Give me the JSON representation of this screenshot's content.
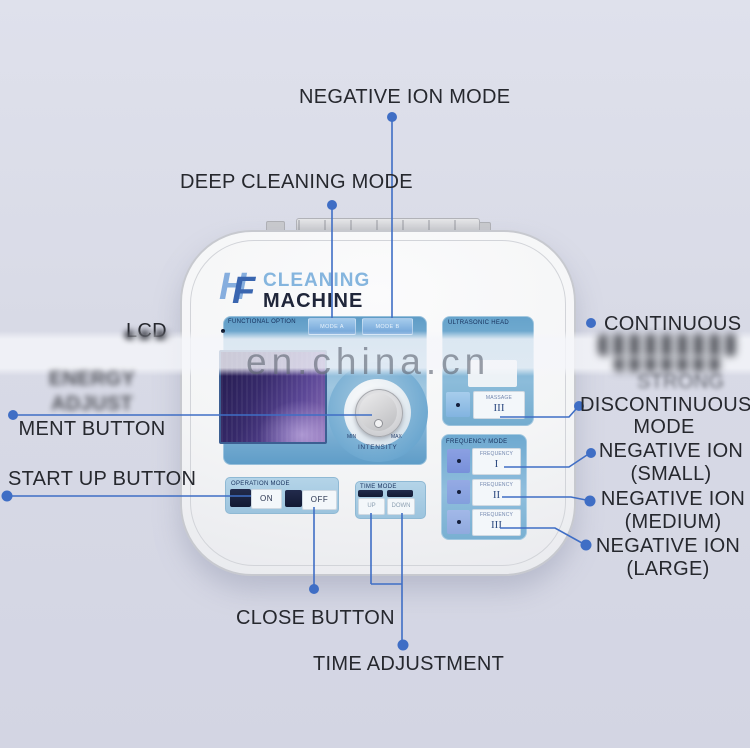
{
  "watermark": {
    "text": "en.china.cn"
  },
  "logo": {
    "initial_h": "H",
    "initial_f": "F",
    "name_line1": "CLEANING",
    "name_line2": "MACHINE"
  },
  "panel_functional": {
    "title": "FUNCTIONAL OPTION",
    "mode_a": "MODE A",
    "mode_b": "MODE B",
    "min": "MIN",
    "max": "MAX",
    "intensity": "INTENSITY"
  },
  "panel_ultrasonic": {
    "title": "ULTRASONIC HEAD",
    "massage_caption": "MASSAGE",
    "massage_numeral": "III"
  },
  "panel_frequency": {
    "title": "FREQUENCY MODE",
    "rows": [
      {
        "caption": "FREQUENCY",
        "numeral": "I"
      },
      {
        "caption": "FREQUENCY",
        "numeral": "II"
      },
      {
        "caption": "FREQUENCY",
        "numeral": "III"
      }
    ]
  },
  "panel_operation": {
    "title": "OPERATION MODE",
    "on_label": "ON",
    "off_label": "OFF"
  },
  "panel_time": {
    "title": "TIME MODE",
    "up_label": "UP",
    "down_label": "DOWN"
  },
  "callouts": {
    "negative_ion_mode": "NEGATIVE ION MODE",
    "deep_cleaning_mode": "DEEP CLEANING MODE",
    "lcd": "LCD",
    "energy_line1": "ENERGY ADJUST",
    "energy_line2": "MENT BUTTON",
    "start_up": "START UP BUTTON",
    "close": "CLOSE BUTTON",
    "time_adjustment": "TIME ADJUSTMENT",
    "continuous": "CONTINUOUS",
    "strong": "STRONG",
    "discontinuous_line1": "DISCONTINUOUS",
    "discontinuous_line2": "MODE",
    "neg_small_line1": "NEGATIVE ION",
    "neg_small_line2": "(SMALL)",
    "neg_medium_line1": "NEGATIVE ION",
    "neg_medium_line2": "(MEDIUM)",
    "neg_large_line1": "NEGATIVE ION",
    "neg_large_line2": "(LARGE)"
  },
  "colors": {
    "accent_line": "#3f6ec5",
    "panel_blue": "#74aed2",
    "dark_key": "#18203e",
    "lcd_purple": "#43337a",
    "background": "#d8dae6"
  }
}
